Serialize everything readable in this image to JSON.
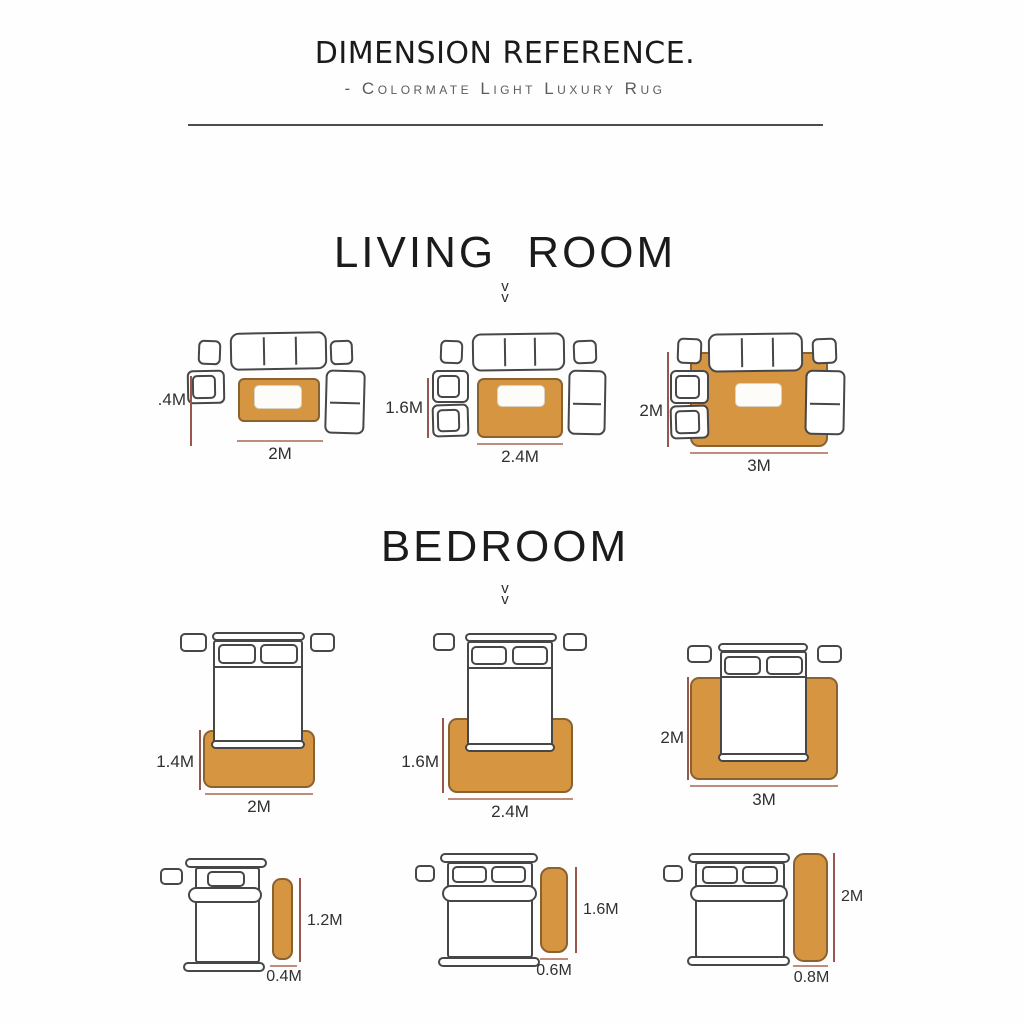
{
  "header": {
    "title": "DIMENSION REFERENCE.",
    "subtitle": "- Colormate Light Luxury Rug"
  },
  "icons": {
    "chevron_down": "v"
  },
  "colors": {
    "rug": "#d69540",
    "rug_border": "#8a6130",
    "outline": "#474747",
    "dim_line_v": "#99564c",
    "dim_line_h": "#c08d7d",
    "heading": "#1b1b1b",
    "subtitle": "#5c5c5c",
    "label": "#303030"
  },
  "living_room": {
    "heading": "LIVING ROOM",
    "layouts": [
      {
        "height_label": ".4M",
        "width_label": "2M"
      },
      {
        "height_label": "1.6M",
        "width_label": "2.4M"
      },
      {
        "height_label": "2M",
        "width_label": "3M"
      }
    ]
  },
  "bedroom": {
    "heading": "BEDROOM",
    "layouts": [
      {
        "height_label": "1.4M",
        "width_label": "2M"
      },
      {
        "height_label": "1.6M",
        "width_label": "2.4M"
      },
      {
        "height_label": "2M",
        "width_label": "3M"
      }
    ],
    "runners": [
      {
        "height_label": "1.2M",
        "width_label": "0.4M"
      },
      {
        "height_label": "1.6M",
        "width_label": "0.6M"
      },
      {
        "height_label": "2M",
        "width_label": "0.8M"
      }
    ]
  }
}
